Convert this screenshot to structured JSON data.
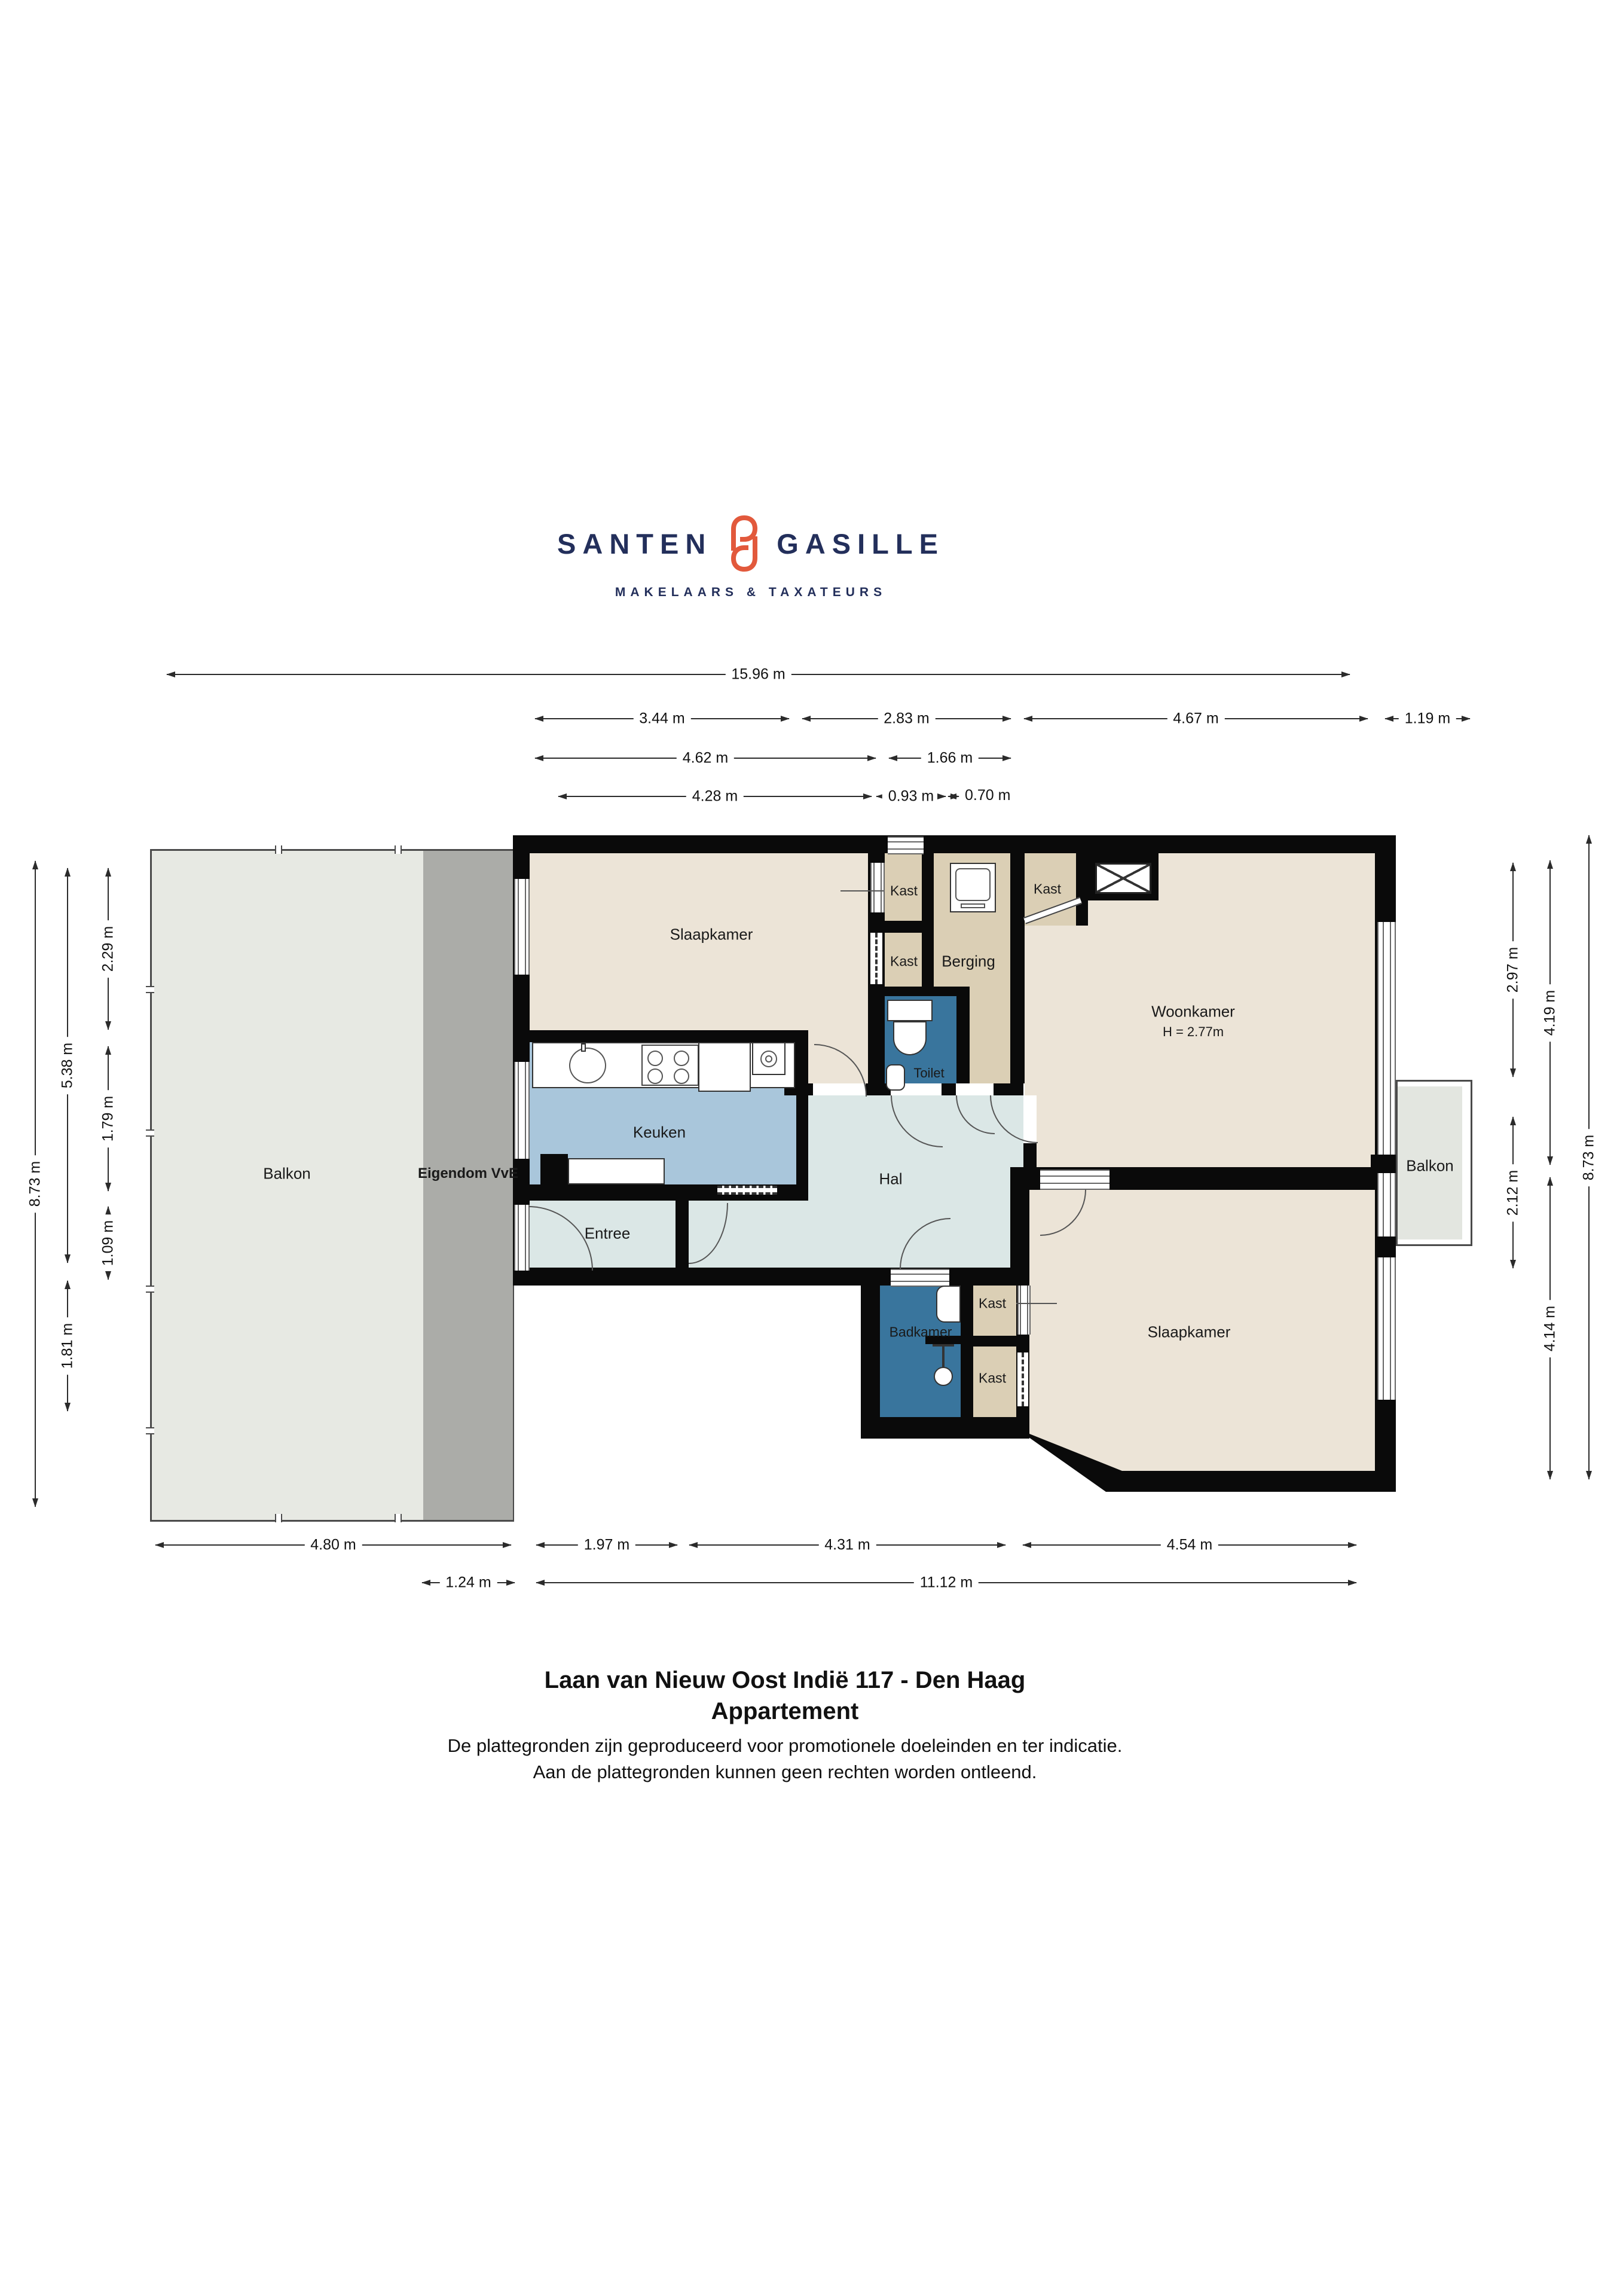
{
  "logo": {
    "brand_left": "SANTEN",
    "brand_right": "GASILLE",
    "tagline": "MAKELAARS & TAXATEURS",
    "emblem_color": "#E2593C",
    "text_color": "#232F5B"
  },
  "dimensions": {
    "top": {
      "total": "15.96 m",
      "r2_1": "3.44 m",
      "r2_2": "2.83 m",
      "r2_3": "4.67 m",
      "r2_4": "1.19 m",
      "r3_1": "4.62 m",
      "r3_2": "1.66 m",
      "r4_1": "4.28 m",
      "r4_2": "0.93 m",
      "r4_3": "0.70 m"
    },
    "bottom": {
      "r1_1": "4.80 m",
      "r1_2": "1.97 m",
      "r1_3": "4.31 m",
      "r1_4": "4.54 m",
      "r2_1": "1.24 m",
      "r2_2": "11.12 m"
    },
    "left": {
      "c1": "8.73 m",
      "c2_1": "5.38 m",
      "c2_2": "1.81 m",
      "c3_1": "2.29 m",
      "c3_2": "1.79 m",
      "c3_3": "1.09 m"
    },
    "right": {
      "c1_1": "2.97 m",
      "c1_2": "2.12 m",
      "c2_1": "4.19 m",
      "c2_2": "4.14 m",
      "c3": "8.73 m"
    }
  },
  "rooms": {
    "balkon_left": "Balkon",
    "eigendom_vve": "Eigendom VvE",
    "slaapkamer_1": "Slaapkamer",
    "kast_1": "Kast",
    "kast_2": "Kast",
    "kast_3": "Kast",
    "berging": "Berging",
    "toilet": "Toilet",
    "woonkamer": "Woonkamer",
    "woonkamer_height": "H = 2.77m",
    "keuken": "Keuken",
    "hal": "Hal",
    "entree": "Entree",
    "badkamer": "Badkamer",
    "kast_4": "Kast",
    "kast_5": "Kast",
    "slaapkamer_2": "Slaapkamer",
    "balkon_right": "Balkon"
  },
  "colors": {
    "wall": "#0A0A0A",
    "room_beige": "#ECE4D7",
    "closet_tan": "#DBCFB5",
    "kitchen_blue": "#A9C6DB",
    "hall_grey": "#DBE7E6",
    "bath_blue": "#39759D",
    "balcony_grey": "#E7E9E3",
    "vve_grey": "#ABACA8"
  },
  "footer": {
    "address": "Laan van Nieuw Oost Indië 117 - Den Haag",
    "subtitle": "Appartement",
    "disclaimer_1": "De plattegronden zijn geproduceerd voor promotionele doeleinden en ter indicatie.",
    "disclaimer_2": "Aan de plattegronden kunnen geen rechten worden ontleend."
  }
}
